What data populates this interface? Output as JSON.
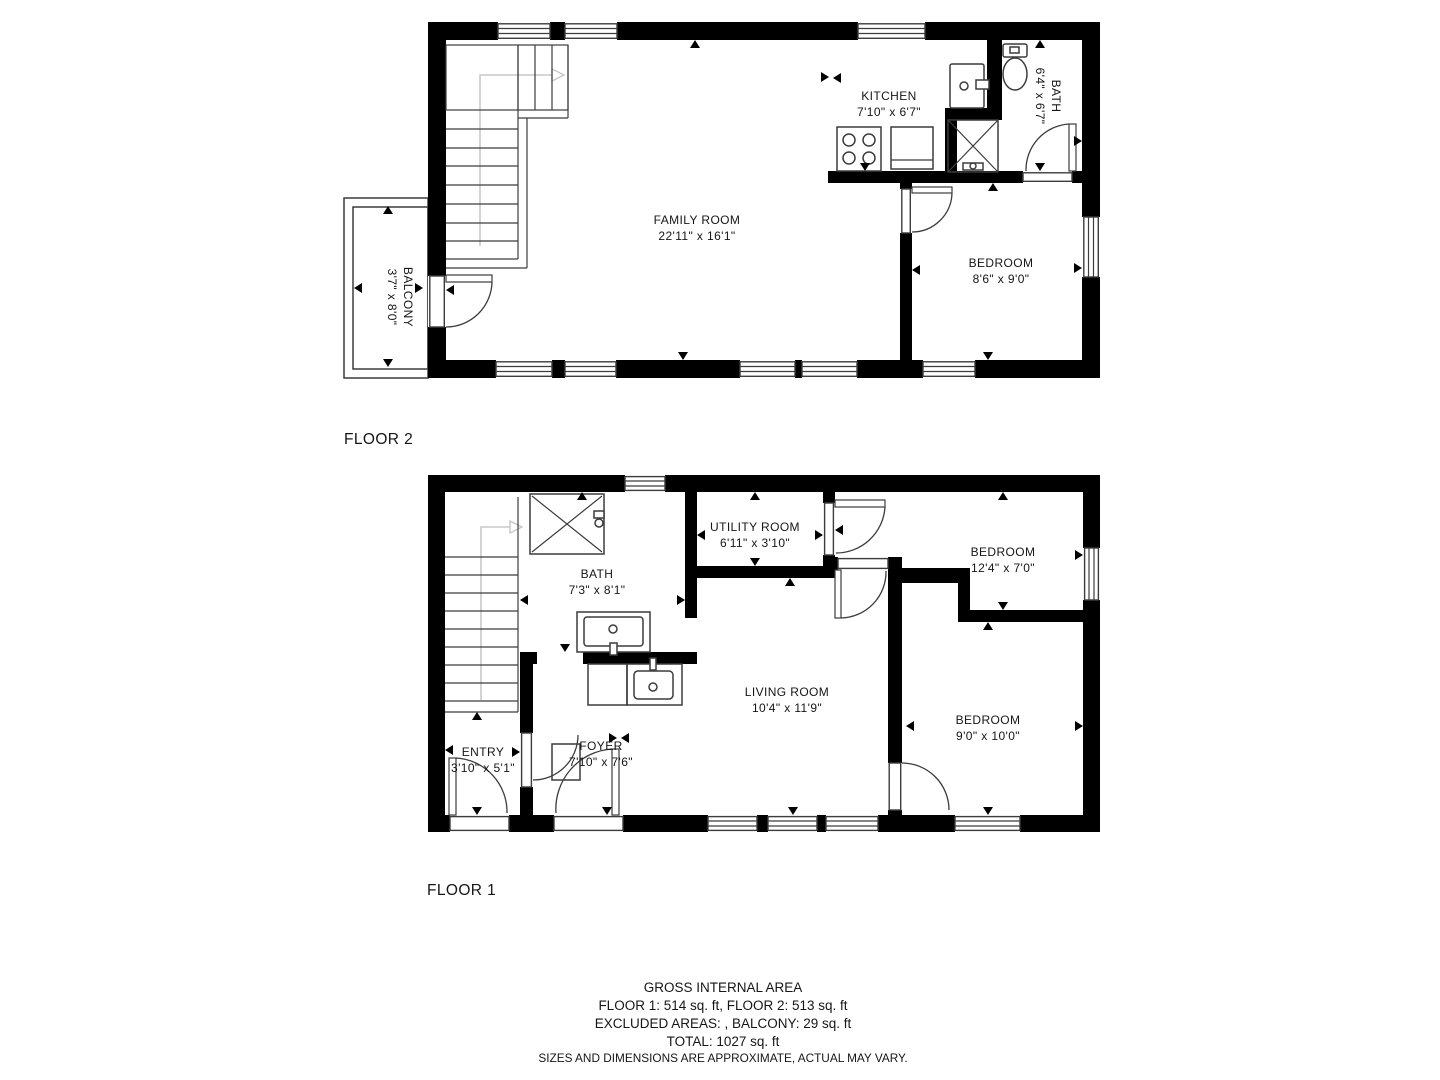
{
  "colors": {
    "walls": "#000000",
    "background": "#ffffff",
    "thin_lines": "#3c3c3c",
    "stair_arrow": "#c8c8c8"
  },
  "floor2": {
    "label": "FLOOR 2",
    "rooms": {
      "family": {
        "name": "FAMILY ROOM",
        "dims": "22'11\" x 16'1\""
      },
      "kitchen": {
        "name": "KITCHEN",
        "dims": "7'10\" x 6'7\""
      },
      "bath": {
        "name": "BATH",
        "dims": "6'4\" x 6'7\""
      },
      "bedroom": {
        "name": "BEDROOM",
        "dims": "8'6\" x 9'0\""
      },
      "balcony": {
        "name": "BALCONY",
        "dims": "3'7\" x 8'0\""
      }
    }
  },
  "floor1": {
    "label": "FLOOR 1",
    "rooms": {
      "entry": {
        "name": "ENTRY",
        "dims": "3'10\" x 5'1\""
      },
      "foyer": {
        "name": "FOYER",
        "dims": "7'10\" x 7'6\""
      },
      "bath": {
        "name": "BATH",
        "dims": "7'3\" x 8'1\""
      },
      "utility": {
        "name": "UTILITY ROOM",
        "dims": "6'11\" x 3'10\""
      },
      "living": {
        "name": "LIVING ROOM",
        "dims": "10'4\" x 11'9\""
      },
      "bedroom1": {
        "name": "BEDROOM",
        "dims": "12'4\" x 7'0\""
      },
      "bedroom2": {
        "name": "BEDROOM",
        "dims": "9'0\" x 10'0\""
      }
    }
  },
  "footer": {
    "line1": "GROSS INTERNAL AREA",
    "line2": "FLOOR 1: 514 sq. ft, FLOOR 2: 513 sq. ft",
    "line3": "EXCLUDED AREAS: , BALCONY: 29 sq. ft",
    "line4": "TOTAL: 1027 sq. ft",
    "line5": "SIZES AND DIMENSIONS ARE APPROXIMATE, ACTUAL MAY VARY."
  }
}
